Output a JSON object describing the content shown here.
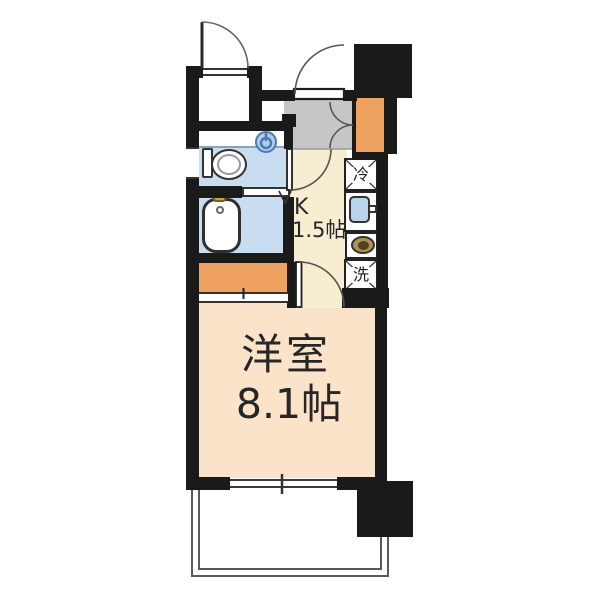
{
  "floorplan": {
    "main_room": {
      "name": "洋室",
      "size": "8.1帖"
    },
    "kitchen": {
      "label": "K",
      "size": "1.5帖"
    },
    "refrigerator_label": "冷",
    "washer_label": "洗",
    "colors": {
      "main_room_floor": "#FAE3C8",
      "kitchen_floor": "#F7EDD1",
      "closet_orange": "#EFA25F",
      "wet_area_blue": "#C9DDF0",
      "entrance_gray": "#C6C6C8",
      "wall_black": "#1A1A1A",
      "sink_blue": "#B9D4EC",
      "burner_gold": "#AD9352",
      "faucet_gold": "#C9A23C",
      "basin_ring_blue": "#4E79AF"
    }
  }
}
